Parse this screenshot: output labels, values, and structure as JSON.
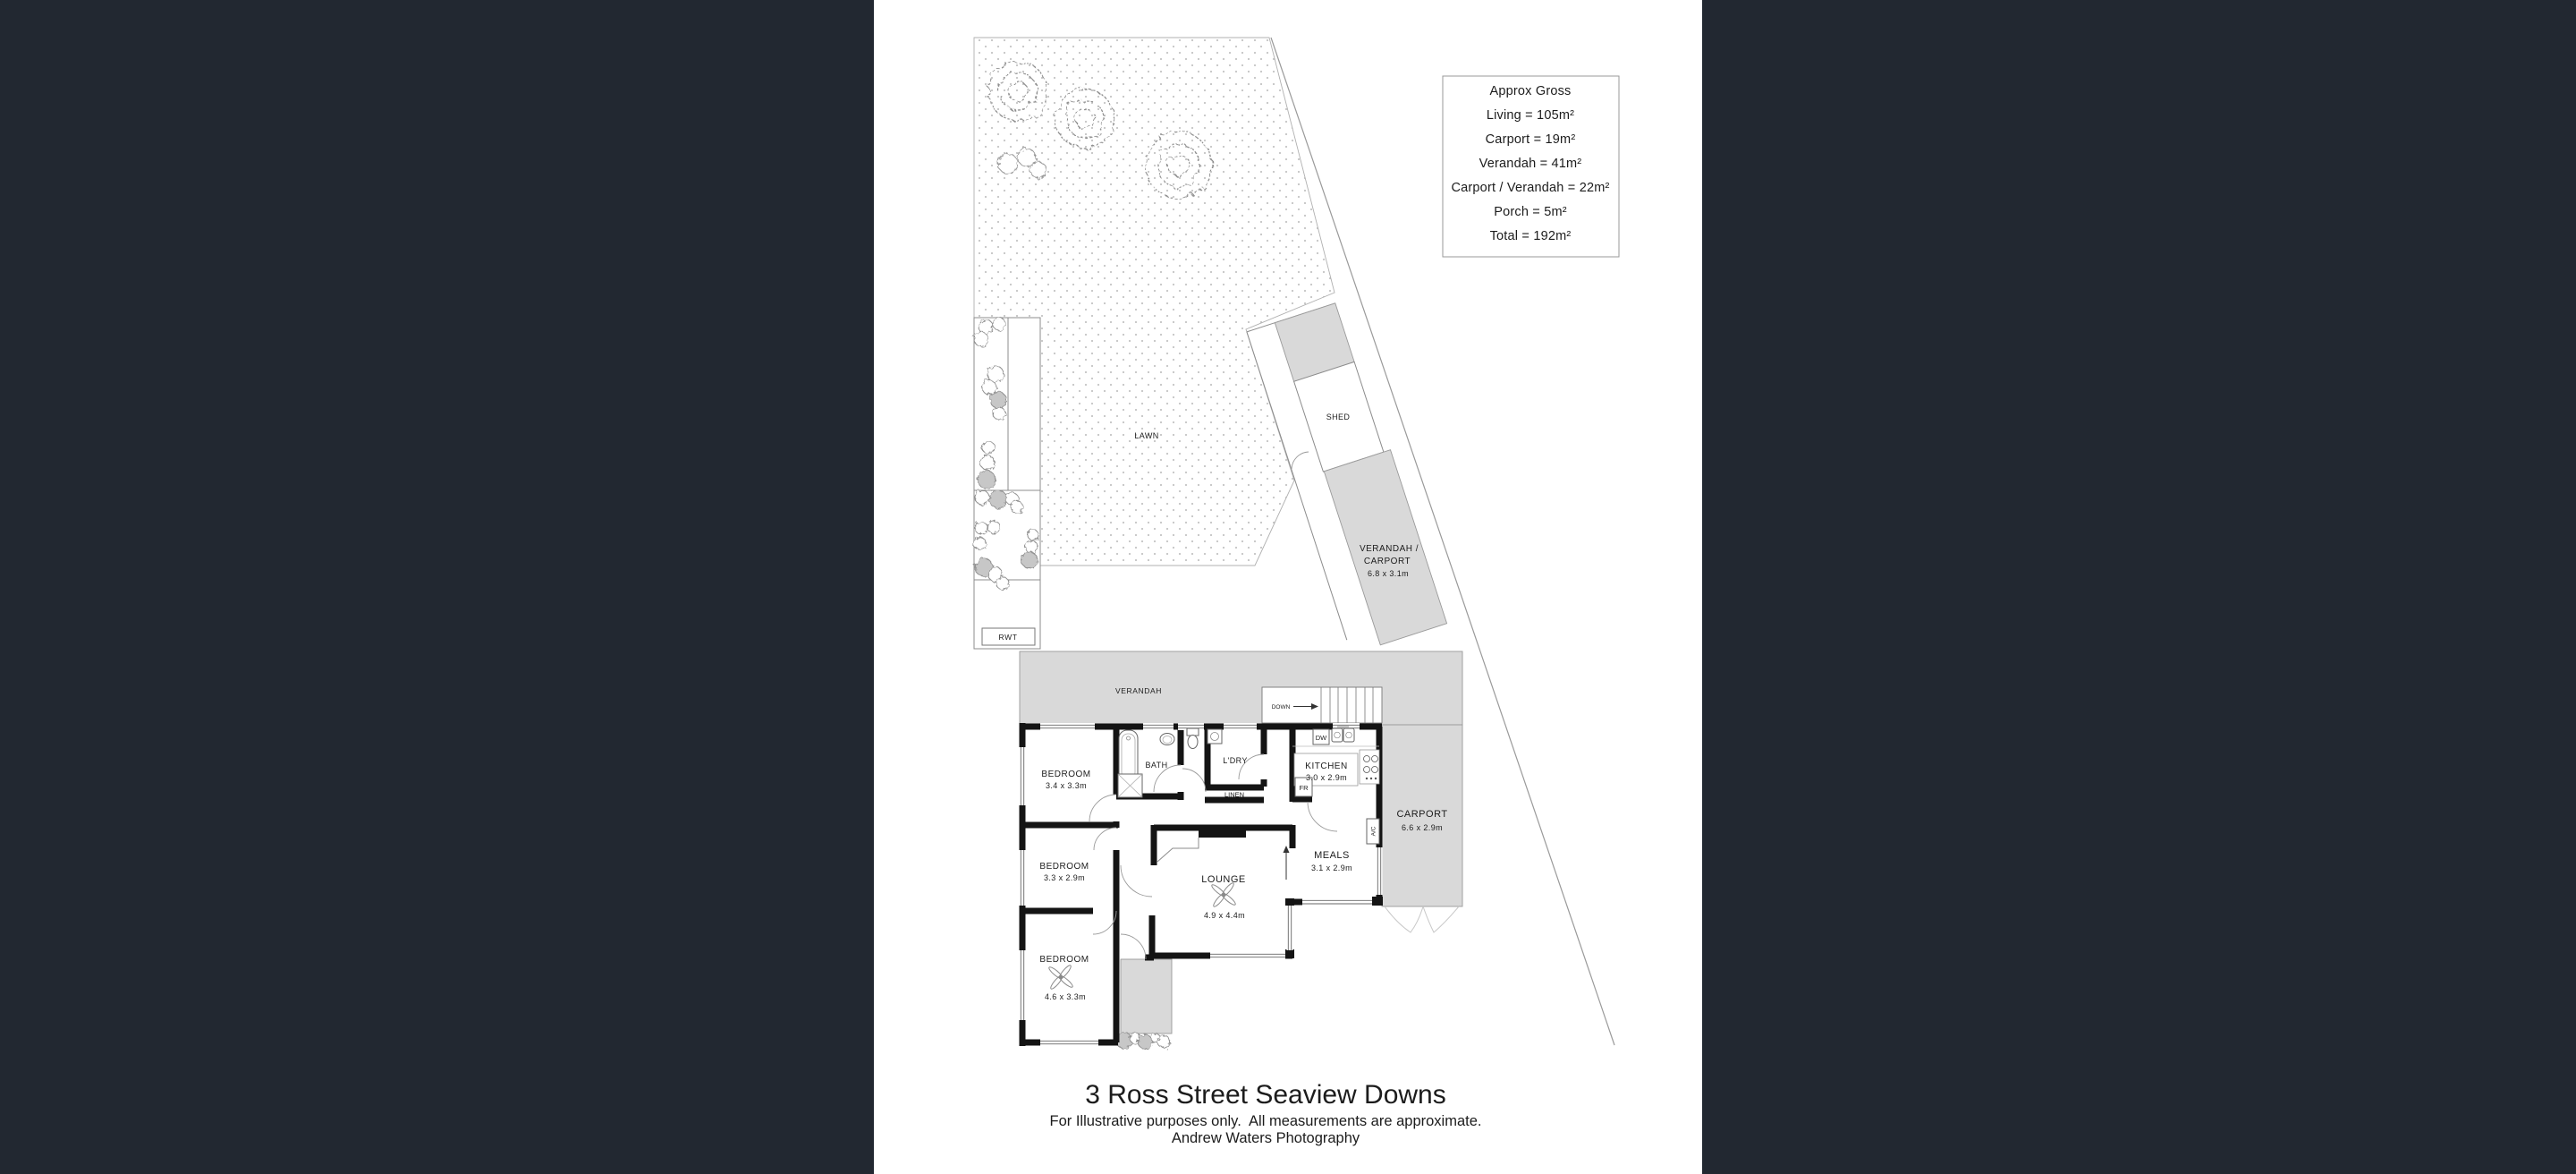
{
  "colors": {
    "canvas": "#222831",
    "paper": "#ffffff",
    "area_gray": "#d9d9d9",
    "wall_black": "#141414",
    "line_gray": "#999999",
    "lawn_dot": "#c4c4c4"
  },
  "area_summary": {
    "title": "Approx Gross",
    "lines": [
      "Living = 105m²",
      "Carport = 19m²",
      "Verandah = 41m²",
      "Carport / Verandah = 22m²",
      "Porch = 5m²",
      "Total = 192m²"
    ]
  },
  "site": {
    "lawn": "LAWN",
    "shed": "SHED",
    "rwt": "RWT",
    "verandah_carport_line1": "VERANDAH /",
    "verandah_carport_line2": "CARPORT",
    "verandah_carport_dims": "6.8 x 3.1m"
  },
  "floorplan": {
    "verandah": "VERANDAH",
    "down": "DOWN",
    "bedroom1": {
      "name": "BEDROOM",
      "dims": "3.4 x 3.3m"
    },
    "bedroom2": {
      "name": "BEDROOM",
      "dims": "3.3 x 2.9m"
    },
    "bedroom3": {
      "name": "BEDROOM",
      "dims": "4.6 x 3.3m"
    },
    "bath": "BATH",
    "laundry": "L'DRY",
    "linen": "LINEN",
    "kitchen": {
      "name": "KITCHEN",
      "dims": "3.0 x 2.9m"
    },
    "fridge": "FR",
    "dishwasher": "DW",
    "ac": "A/C",
    "meals": {
      "name": "MEALS",
      "dims": "3.1 x 2.9m"
    },
    "lounge": {
      "name": "LOUNGE",
      "dims": "4.9 x 4.4m"
    },
    "carport": {
      "name": "CARPORT",
      "dims": "6.6 x 2.9m"
    }
  },
  "footer": {
    "title": "3 Ross Street Seaview Downs",
    "disclaimer": "For Illustrative purposes only.  All measurements are approximate.",
    "credit": "Andrew Waters Photography"
  }
}
